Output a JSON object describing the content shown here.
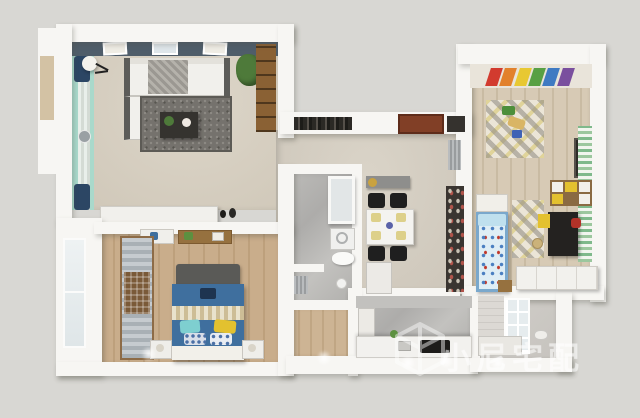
{
  "watermark": {
    "text": "小尼宅配",
    "logo": "cube-logo-icon"
  },
  "palette": {
    "background": "#d8d7d3",
    "wall_white": "#f7f6f3",
    "living_tv_wall": "#4f5d6a",
    "living_curtain_wall_teal": "#a9d9cb",
    "curtain_navy": "#2c4664",
    "bedroom_wood_floor": "#c4a681",
    "kids_wood_floor": "#d3c6b0",
    "hall_floor_beige": "#d5cfc3",
    "bath_marble_gray": "#b5b4b1",
    "master_bed_blue": "#3f6f9e",
    "kids_bed_blue": "#5c8fc7",
    "living_rug_gray": "#75726d",
    "accent_yellow": "#e3c12f",
    "entry_door_brown": "#813f26",
    "rainbow_art_colors": [
      "#d23b2f",
      "#e2812c",
      "#e8c832",
      "#58a044",
      "#3f7ac2",
      "#7a4f9e"
    ]
  },
  "rooms": [
    {
      "name": "living-room"
    },
    {
      "name": "entry-hall"
    },
    {
      "name": "dining-area"
    },
    {
      "name": "bathroom"
    },
    {
      "name": "master-bedroom"
    },
    {
      "name": "kids-bedroom"
    },
    {
      "name": "kitchen"
    },
    {
      "name": "utility-balcony"
    }
  ]
}
